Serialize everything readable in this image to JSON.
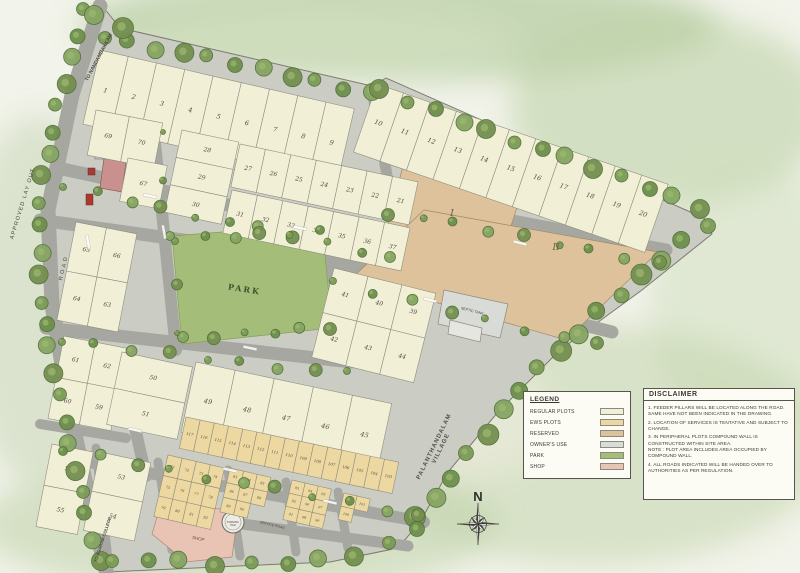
{
  "colors": {
    "regular": "#f2efd7",
    "ews": "#ecd8a0",
    "reserved": "#ddc29c",
    "owners": "#d9dbd7",
    "park": "#a4bd79",
    "shop": "#e9c3b4",
    "road": "#a6a7a1",
    "interior": "#cbccc4",
    "tree_fills": [
      "#7b9b56",
      "#6d8f4b",
      "#86a562",
      "#748f50"
    ],
    "tree_stroke": "#51703a",
    "marker_red": "#a83a32"
  },
  "legend": {
    "title": "LEGEND",
    "items": [
      {
        "label": "REGULAR PLOTS",
        "color_key": "regular"
      },
      {
        "label": "EWS PLOTS",
        "color_key": "ews"
      },
      {
        "label": "RESERVED",
        "color_key": "reserved"
      },
      {
        "label": "OWNER'S USE",
        "color_key": "owners"
      },
      {
        "label": "PARK",
        "color_key": "park"
      },
      {
        "label": "SHOP",
        "color_key": "shop"
      }
    ]
  },
  "disclaimer": {
    "title": "DISCLAIMER",
    "items": [
      "1. FEEDER PILLARS WILL BE LOCATED ALONG THE ROAD. SAME HAVE NOT BEEN INDICATED IN THE DRAWING.",
      "2. LOCATION OF SERVICES IS TENTATIVE AND SUBJECT TO CHANGE.",
      "3. IN PERIPHERAL PLOTS COMPOUND WALL IS CONSTRUCTED WITHIN SITE AREA.\nNOTE : PLOT AREA INCLUDES AREA OCCUPIED BY COMPOUND WALL.",
      "4. ALL ROADS INDICATED WILL BE HANDED OVER TO AUTHORITIES AS PER REGULATION."
    ]
  },
  "labels": {
    "park": "PARK",
    "reserved_1": "I",
    "reserved_2": "II",
    "septic_tank": "SEPTIC TANK",
    "shop_bottom": "SHOP",
    "service_road": "SERVICE ROAD",
    "turning_pad_line1": "TURNING",
    "turning_pad_line2": "PAD",
    "to_nandambakkam": "TO NANDAMBAKKAM",
    "approved_layout": "APPROVED LAY OUT",
    "road": "ROAD",
    "village_line1": "PALANTHANDALAM",
    "village_line2": "VILLAGE",
    "to_college": "TO AGARAM COLLEGE",
    "compass_north": "N"
  },
  "blocks": {
    "top_row_a": [
      [
        "1",
        "2",
        "3",
        "4",
        "5",
        "6",
        "7",
        "8",
        "9"
      ]
    ],
    "top_row_b": [
      [
        "10",
        "11",
        "12",
        "13",
        "14",
        "15",
        "16",
        "17",
        "18",
        "19",
        "20"
      ]
    ],
    "col_69_70": [
      [
        "69",
        "70"
      ]
    ],
    "plot_67": [
      [
        "67"
      ]
    ],
    "col_28_30": [
      [
        "28"
      ],
      [
        "29"
      ],
      [
        "30"
      ]
    ],
    "row_27_21": [
      [
        "27",
        "26",
        "25",
        "24",
        "23",
        "22",
        "21"
      ]
    ],
    "row_31_37": [
      [
        "31",
        "32",
        "33",
        "34",
        "35",
        "36",
        "37"
      ]
    ],
    "blk_65_63": [
      [
        "65",
        "66"
      ],
      [
        "64",
        "63"
      ]
    ],
    "blk_41_44": [
      [
        "41",
        "40",
        "39"
      ],
      [
        "42",
        "43",
        "44"
      ]
    ],
    "blk_61_59": [
      [
        "61",
        "62"
      ],
      [
        "60",
        "59"
      ]
    ],
    "blk_50_51": [
      [
        "50"
      ],
      [
        "51"
      ]
    ],
    "row_49_45": [
      [
        "49",
        "48",
        "47",
        "46",
        "45"
      ]
    ],
    "strip_117_103": [
      [
        "117",
        "116",
        "115",
        "114",
        "113",
        "112",
        "111",
        "110",
        "109",
        "108",
        "107",
        "106",
        "105",
        "104",
        "103"
      ]
    ],
    "blk_58_55": [
      [
        "58"
      ],
      [
        "55"
      ]
    ],
    "blk_53_54": [
      [
        "53"
      ],
      [
        "54"
      ]
    ],
    "ews_a": [
      [
        "71",
        "72",
        "73",
        "74"
      ],
      [
        "75",
        "76",
        "77",
        "78"
      ],
      [
        "79",
        "80",
        "81",
        "82"
      ]
    ],
    "ews_b": [
      [
        "83",
        "84",
        "85"
      ],
      [
        "86",
        "87",
        "88"
      ],
      [
        "89",
        "90",
        ""
      ]
    ],
    "ews_c": [
      [
        "93",
        "94",
        "95"
      ],
      [
        "92",
        "96",
        "97"
      ],
      [
        "91",
        "98",
        "99"
      ]
    ],
    "ews_d": [
      [
        "102",
        "101"
      ],
      [
        "100",
        ""
      ]
    ]
  }
}
